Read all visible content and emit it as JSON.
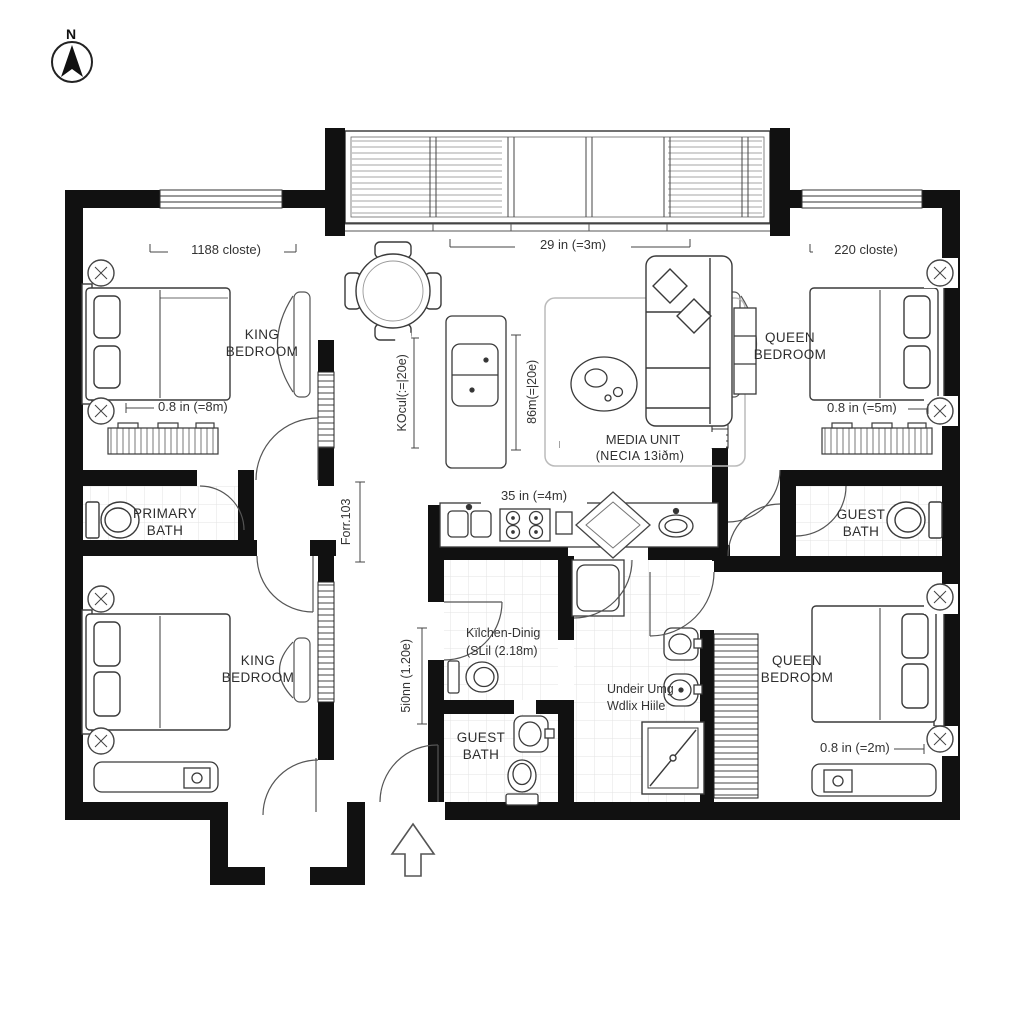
{
  "compass": {
    "label": "N"
  },
  "rooms": {
    "king_top": "KING BEDROOM",
    "queen_top": "QUEEN BEDROOM",
    "primary_bath": "PRIMARY BATH",
    "guest_bath_right": "GUEST BATH",
    "king_bottom": "KING BEDROOM",
    "queen_bottom": "QUEEN BEDROOM",
    "guest_bath_bottom": "GUEST BATH"
  },
  "annotations": {
    "media_unit_line1": "MEDIA UNIT",
    "media_unit_line2": "(NECIA 13iðm)",
    "kitchen_dining_line1": "Kïlchen-Dinig",
    "kitchen_dining_line2": "(SLil (2.18m)",
    "utility_line1": "Undeir Umg",
    "utility_line2": "Wdlix Hiile"
  },
  "dimensions": {
    "closet_left": "1188 closte)",
    "overall_top": "29 in (=3m)",
    "closet_right": "220 closte)",
    "king_top_bed": "0.8 in (=8m)",
    "queen_top_bed": "0.8 in (=5m)",
    "island_left": "KOcul(:=|20e)",
    "island_right": "86m(=|20e)",
    "kitchen_run": "35 in (=4m)",
    "hall_left": "Forr.103",
    "hall_lower": "5i0nn (1.20e)",
    "queen_bottom_bed": "0.8 in (=2m)"
  },
  "icons": [
    "north-compass",
    "king-bed",
    "queen-bed",
    "nightstand-lamp",
    "dresser",
    "wardrobe-door",
    "dining-table",
    "dining-chair",
    "kitchen-island",
    "kitchen-counter",
    "cooktop",
    "double-sink",
    "counter-sink",
    "sofa",
    "throw-pillow",
    "coffee-table",
    "media-console",
    "rug",
    "toilet",
    "vanity-sink",
    "shower",
    "washer",
    "closet-rail",
    "door-swing",
    "entry-arrow",
    "window",
    "glazed-wall"
  ],
  "colors": {
    "wall": "#111111",
    "line": "#3a3a3a",
    "tile_line": "#e3e3e3",
    "background": "#ffffff",
    "text": "#2b2b2b"
  }
}
